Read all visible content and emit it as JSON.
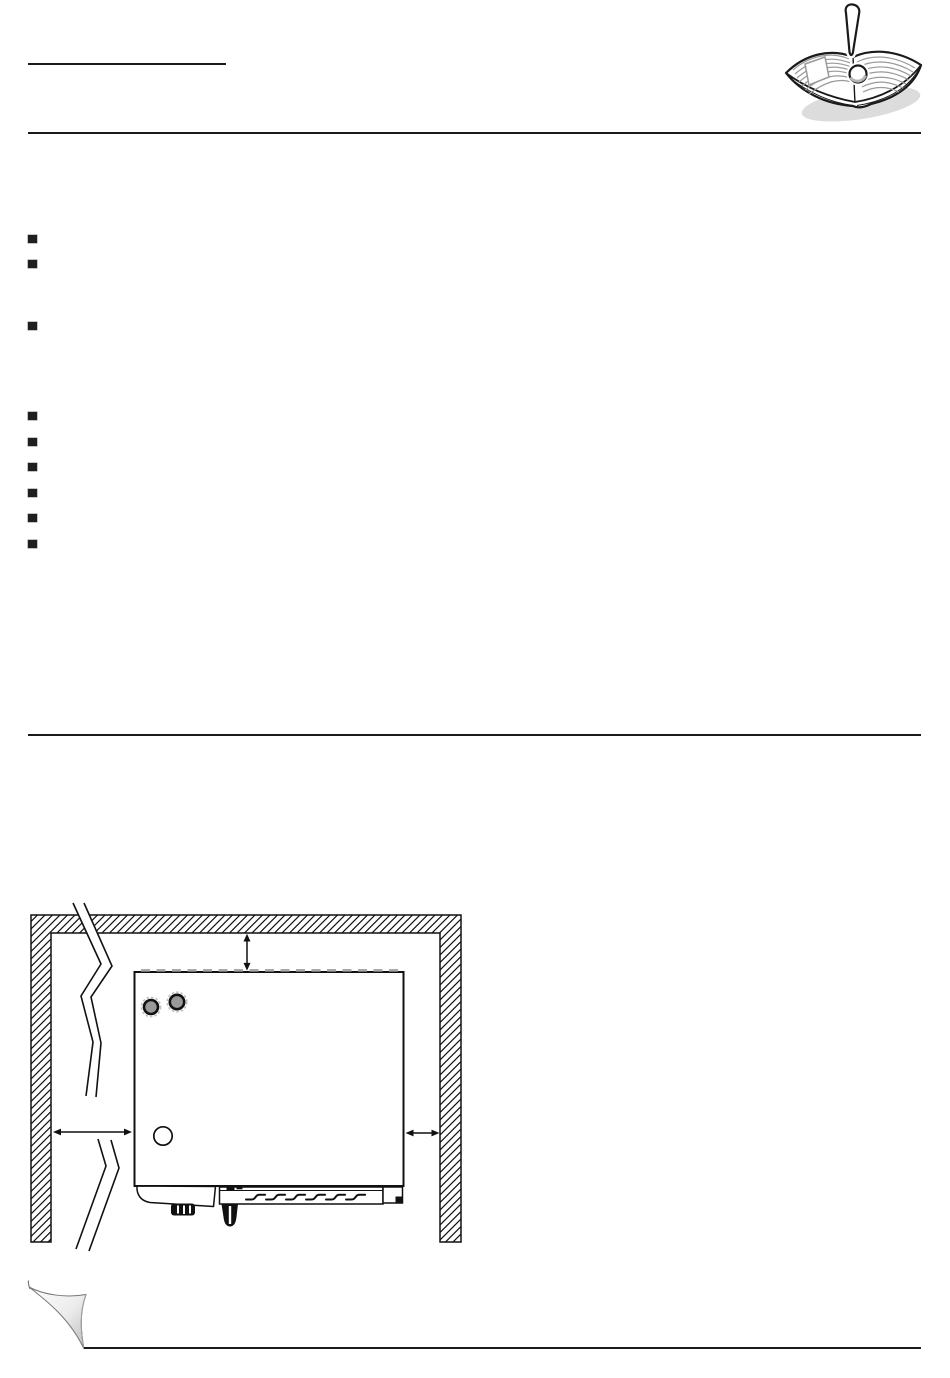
{
  "page": {
    "kind": "manual-page",
    "background": "#ffffff",
    "rule_color": "#1a1a1a"
  },
  "header": {
    "title_underline_present": true,
    "manual_icon": "open-book-exclamation-icon"
  },
  "bullet_lists": {
    "marker_style": "filled-square",
    "marker_color": "#1f1f1f",
    "groups": [
      {
        "name": "notes-group-1",
        "y_positions": [
          235,
          260,
          322
        ]
      },
      {
        "name": "notes-group-2",
        "y_positions": [
          412,
          438,
          463,
          489,
          514,
          540
        ]
      }
    ]
  },
  "diagram": {
    "name": "installation-clearance-top-view",
    "line_color": "#111111",
    "wall_fill": "diagonal-hatch",
    "knob_color": "#999999",
    "knob_halo_color": "#c0c0c0",
    "knob_count": 2,
    "clearance_arrows": [
      "top",
      "left",
      "right"
    ],
    "wall_break_marks": 2
  },
  "footer": {
    "page_curl_present": true,
    "curl_shade": "#c0c0c0"
  }
}
